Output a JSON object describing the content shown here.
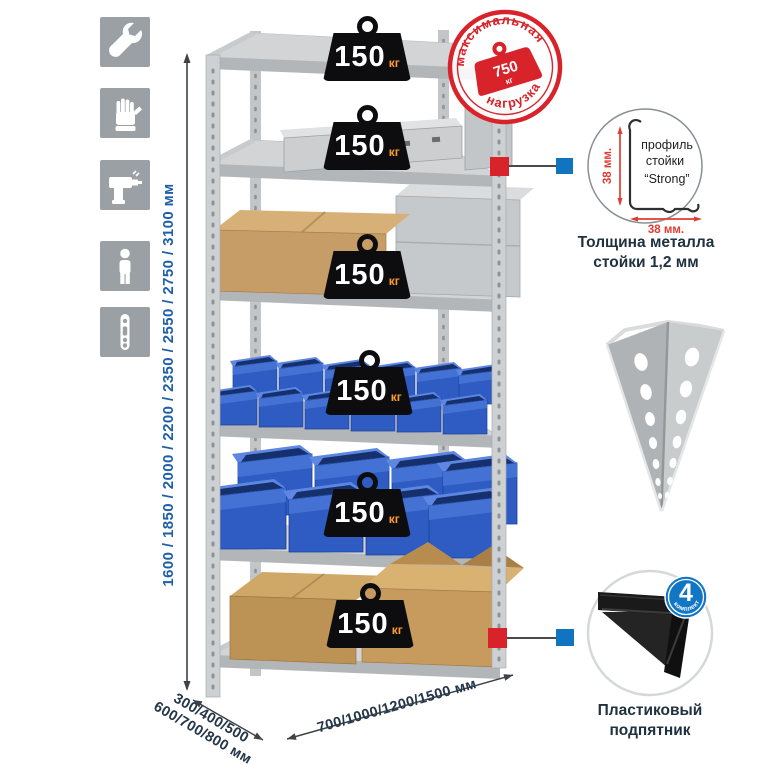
{
  "tool_icons": [
    "wrench",
    "gloves",
    "drill",
    "person",
    "rack-post"
  ],
  "rack": {
    "shelf_loads": [
      "150",
      "150",
      "150",
      "150",
      "150",
      "150"
    ],
    "load_unit": "кг"
  },
  "max_load_stamp": {
    "top_text": "максимальная",
    "bottom_text": "нагрузка",
    "value": "750",
    "unit": "кг"
  },
  "dimensions": {
    "height": "1600 / 1850 / 2000 / 2200 / 2350 / 2550 / 2750 / 3100 мм",
    "depth_line1": "300/400/500",
    "depth_line2": "600/700/800 мм",
    "width": "700/1000/1200/1500 мм"
  },
  "profile_detail": {
    "label_line1": "профиль",
    "label_line2": "стойки",
    "label_line3": "“Strong”",
    "dim_vertical": "38 мм.",
    "dim_horizontal": "38 мм.",
    "caption": "Толщина металла стойки 1,2 мм"
  },
  "foot_detail": {
    "badge_value": "4",
    "badge_text": "в комплекте",
    "caption": "Пластиковый подпятник"
  },
  "colors": {
    "stamp_red": "#d8232a",
    "marker_red": "#d8232a",
    "marker_blue": "#1273bf",
    "dim_blue": "#1d5fa9",
    "dark_navy": "#20313f",
    "unit_orange": "#ff9b2d",
    "bin_blue": "#2e5cc2"
  }
}
